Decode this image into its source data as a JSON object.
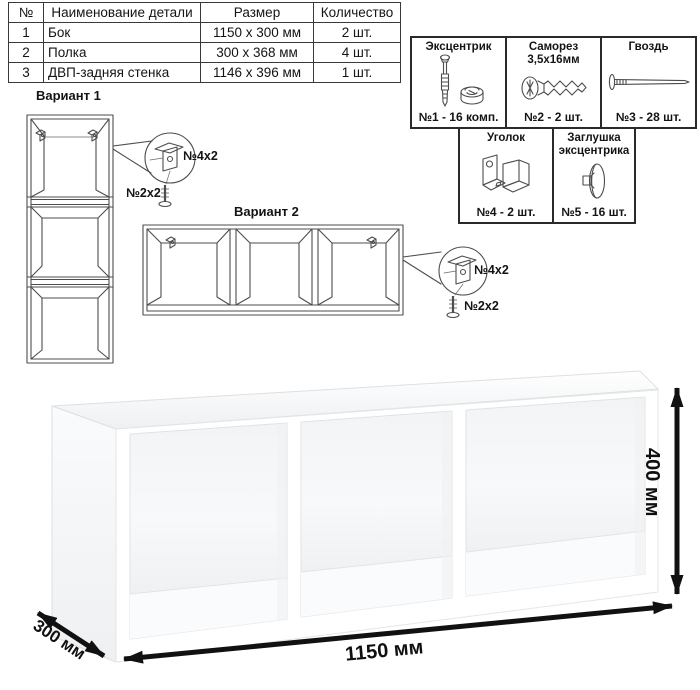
{
  "colors": {
    "background": "#ffffff",
    "line_art": "#4d4d4d",
    "text": "#141414",
    "arrow": "#111111",
    "table_border": "#3a3a3a"
  },
  "parts_table": {
    "headers": [
      "№",
      "Наименование детали",
      "Размер",
      "Количество"
    ],
    "rows": [
      [
        "1",
        "Бок",
        "1150 x 300 мм",
        "2 шт."
      ],
      [
        "2",
        "Полка",
        "300 x 368 мм",
        "4 шт."
      ],
      [
        "3",
        "ДВП-задняя стенка",
        "1146 x 396 мм",
        "1 шт."
      ]
    ]
  },
  "hardware": {
    "items": [
      {
        "name": "Эксцентрик",
        "qty": "№1 - 16 комп.",
        "icon": "cam-bolt-icon"
      },
      {
        "name": "Саморез 3,5х16мм",
        "qty": "№2 - 2 шт.",
        "icon": "screw-icon"
      },
      {
        "name": "Гвоздь",
        "qty": "№3 - 28 шт.",
        "icon": "nail-icon"
      },
      {
        "name": "Уголок",
        "qty": "№4 - 2 шт.",
        "icon": "corner-bracket-icon"
      },
      {
        "name": "Заглушка эксцентрика",
        "qty": "№5 - 16 шт.",
        "icon": "cam-cap-icon"
      }
    ]
  },
  "variants": {
    "v1": {
      "title": "Вариант 1",
      "bracket_label": "№4х2",
      "screw_label": "№2х2"
    },
    "v2": {
      "title": "Вариант 2",
      "bracket_label": "№4х2",
      "screw_label": "№2х2"
    }
  },
  "dimensions": {
    "width": "1150 мм",
    "depth": "300 мм",
    "height": "400 мм"
  }
}
